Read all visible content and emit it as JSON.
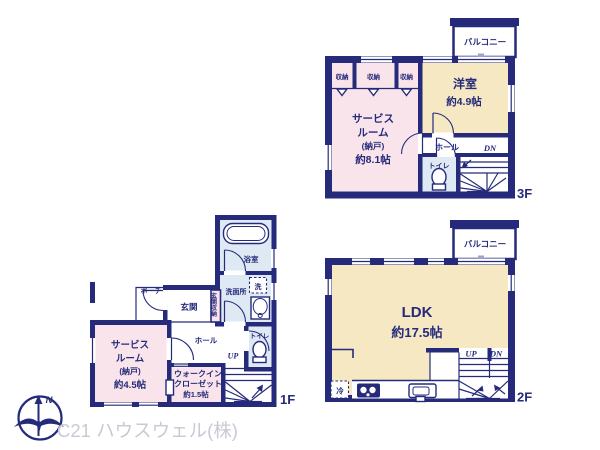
{
  "colors": {
    "wall_navy": "#252b7a",
    "room_pink": "#f9e4eb",
    "room_cream": "#f6e8c3",
    "room_blue": "#dfe9f4",
    "watermark_gray": "#c9c9d5"
  },
  "floor3": {
    "label": "3F",
    "balcony": "バルコニー",
    "closets": [
      "収納",
      "収納",
      "収納"
    ],
    "western_room": {
      "name": "洋室",
      "size": "約4.9帖"
    },
    "service_room": {
      "line1": "サービス",
      "line2": "ルーム",
      "line3": "(納戸)",
      "size": "約8.1帖"
    },
    "hall": "ホール",
    "toilet": "トイレ",
    "stairs_dn": "DN"
  },
  "floor2": {
    "label": "2F",
    "balcony": "バルコニー",
    "ldk": {
      "name": "LDK",
      "size": "約17.5帖"
    },
    "stairs_up": "UP",
    "stairs_dn": "DN",
    "fridge": "冷"
  },
  "floor1": {
    "label": "1F",
    "bath": "浴室",
    "washroom": "洗面所",
    "washer": "洗",
    "entrance": "玄関",
    "entrance_storage": "玄関収納",
    "porch": "ポーチ",
    "service_room": {
      "line1": "サービス",
      "line2": "ルーム",
      "line3": "(納戸)",
      "size": "約4.5帖"
    },
    "hall": "ホール",
    "walk_in_closet": {
      "line1": "ウォークイン",
      "line2": "クローゼット",
      "size": "約1.5帖"
    },
    "toilet": "トイレ",
    "stairs_up": "UP"
  },
  "footer": {
    "company": "C21 ハウスウェル(株)",
    "compass_north": "N"
  }
}
